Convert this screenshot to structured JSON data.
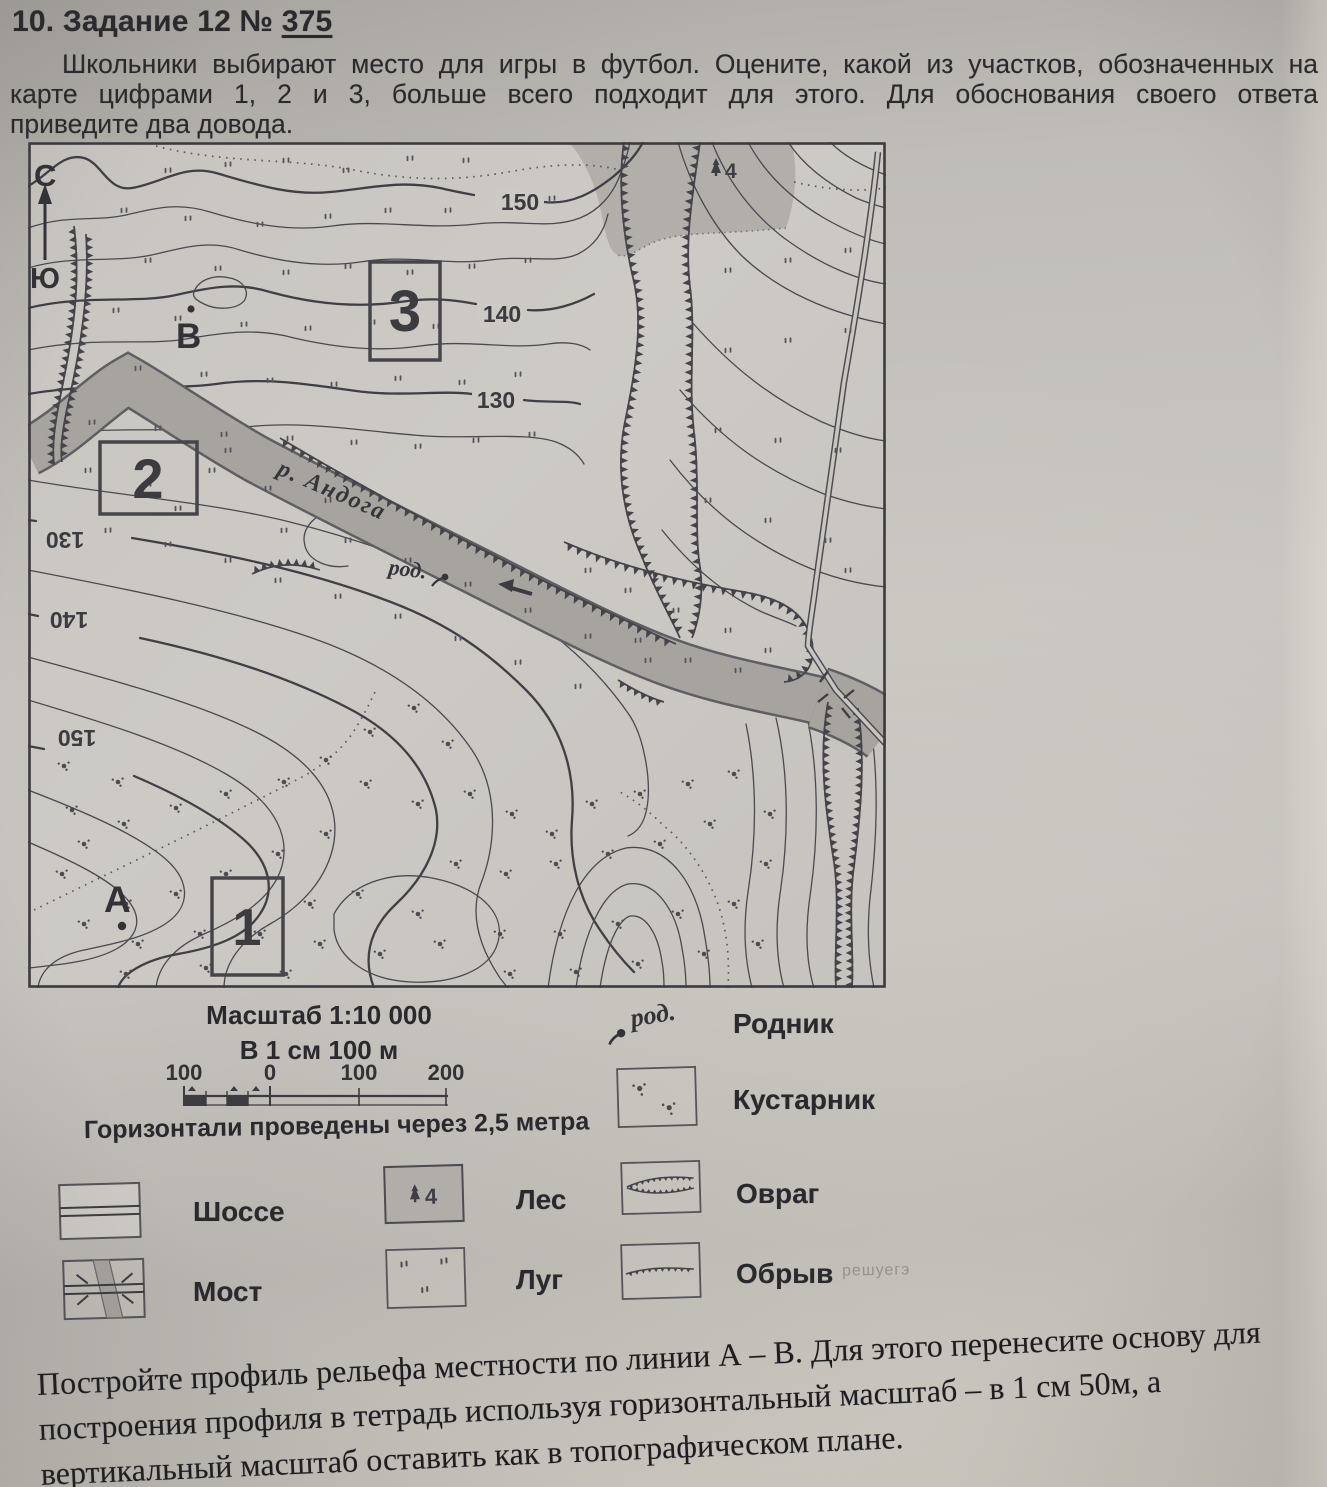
{
  "page": {
    "title_prefix": "10. Задание 12 № ",
    "title_number": "375",
    "task_lines": [
      "Школьники выбирают место для игры в футбол. Оцените, какой из участков, обозначенных на",
      "карте цифрами 1, 2 и 3, больше всего подходит для этого. Для обоснования своего ответа",
      "приведите два довода."
    ],
    "profile_lines": [
      "Постройте профиль рельефа местности по линии А – В. Для этого перенесите основу для",
      "построения профиля в тетрадь используя горизонтальный масштаб – в 1 см 50м, а",
      "вертикальный масштаб оставить как в топографическом плане."
    ]
  },
  "map": {
    "compass_north": "С",
    "compass_south": "Ю",
    "contour_150": "150",
    "contour_140": "140",
    "contour_130": "130",
    "contour_130_mirror": "130",
    "contour_140_mirror": "140",
    "contour_150_mirror": "150",
    "river_label": "р. Андога",
    "spring_label": "род.",
    "point_a": "А",
    "point_b": "В",
    "area_1": "1",
    "area_2": "2",
    "area_3": "3",
    "forest_mark": "4"
  },
  "legend": {
    "scale_title": "Масштаб 1:10 000",
    "scale_subtitle": "В 1 см 100 м",
    "bar_labels": [
      "100",
      "0",
      "100",
      "200"
    ],
    "contour_note": "Горизонтали проведены через 2,5 метра",
    "spring_symbol_text": "род.",
    "items": {
      "highway": "Шоссе",
      "bridge": "Мост",
      "forest": "Лес",
      "meadow": "Луг",
      "spring": "Родник",
      "shrub": "Кустарник",
      "ravine": "Овраг",
      "cliff": "Обрыв"
    },
    "forest_mark": "4",
    "watermark": "решуегэ"
  },
  "colors": {
    "ink": "#2a292d",
    "map_ink": "#4a494f",
    "river_fill": "#a7a49f",
    "river_edge": "#5f5e63",
    "forest_fill": "#b2afaa",
    "paper": "#cbc8c3"
  }
}
